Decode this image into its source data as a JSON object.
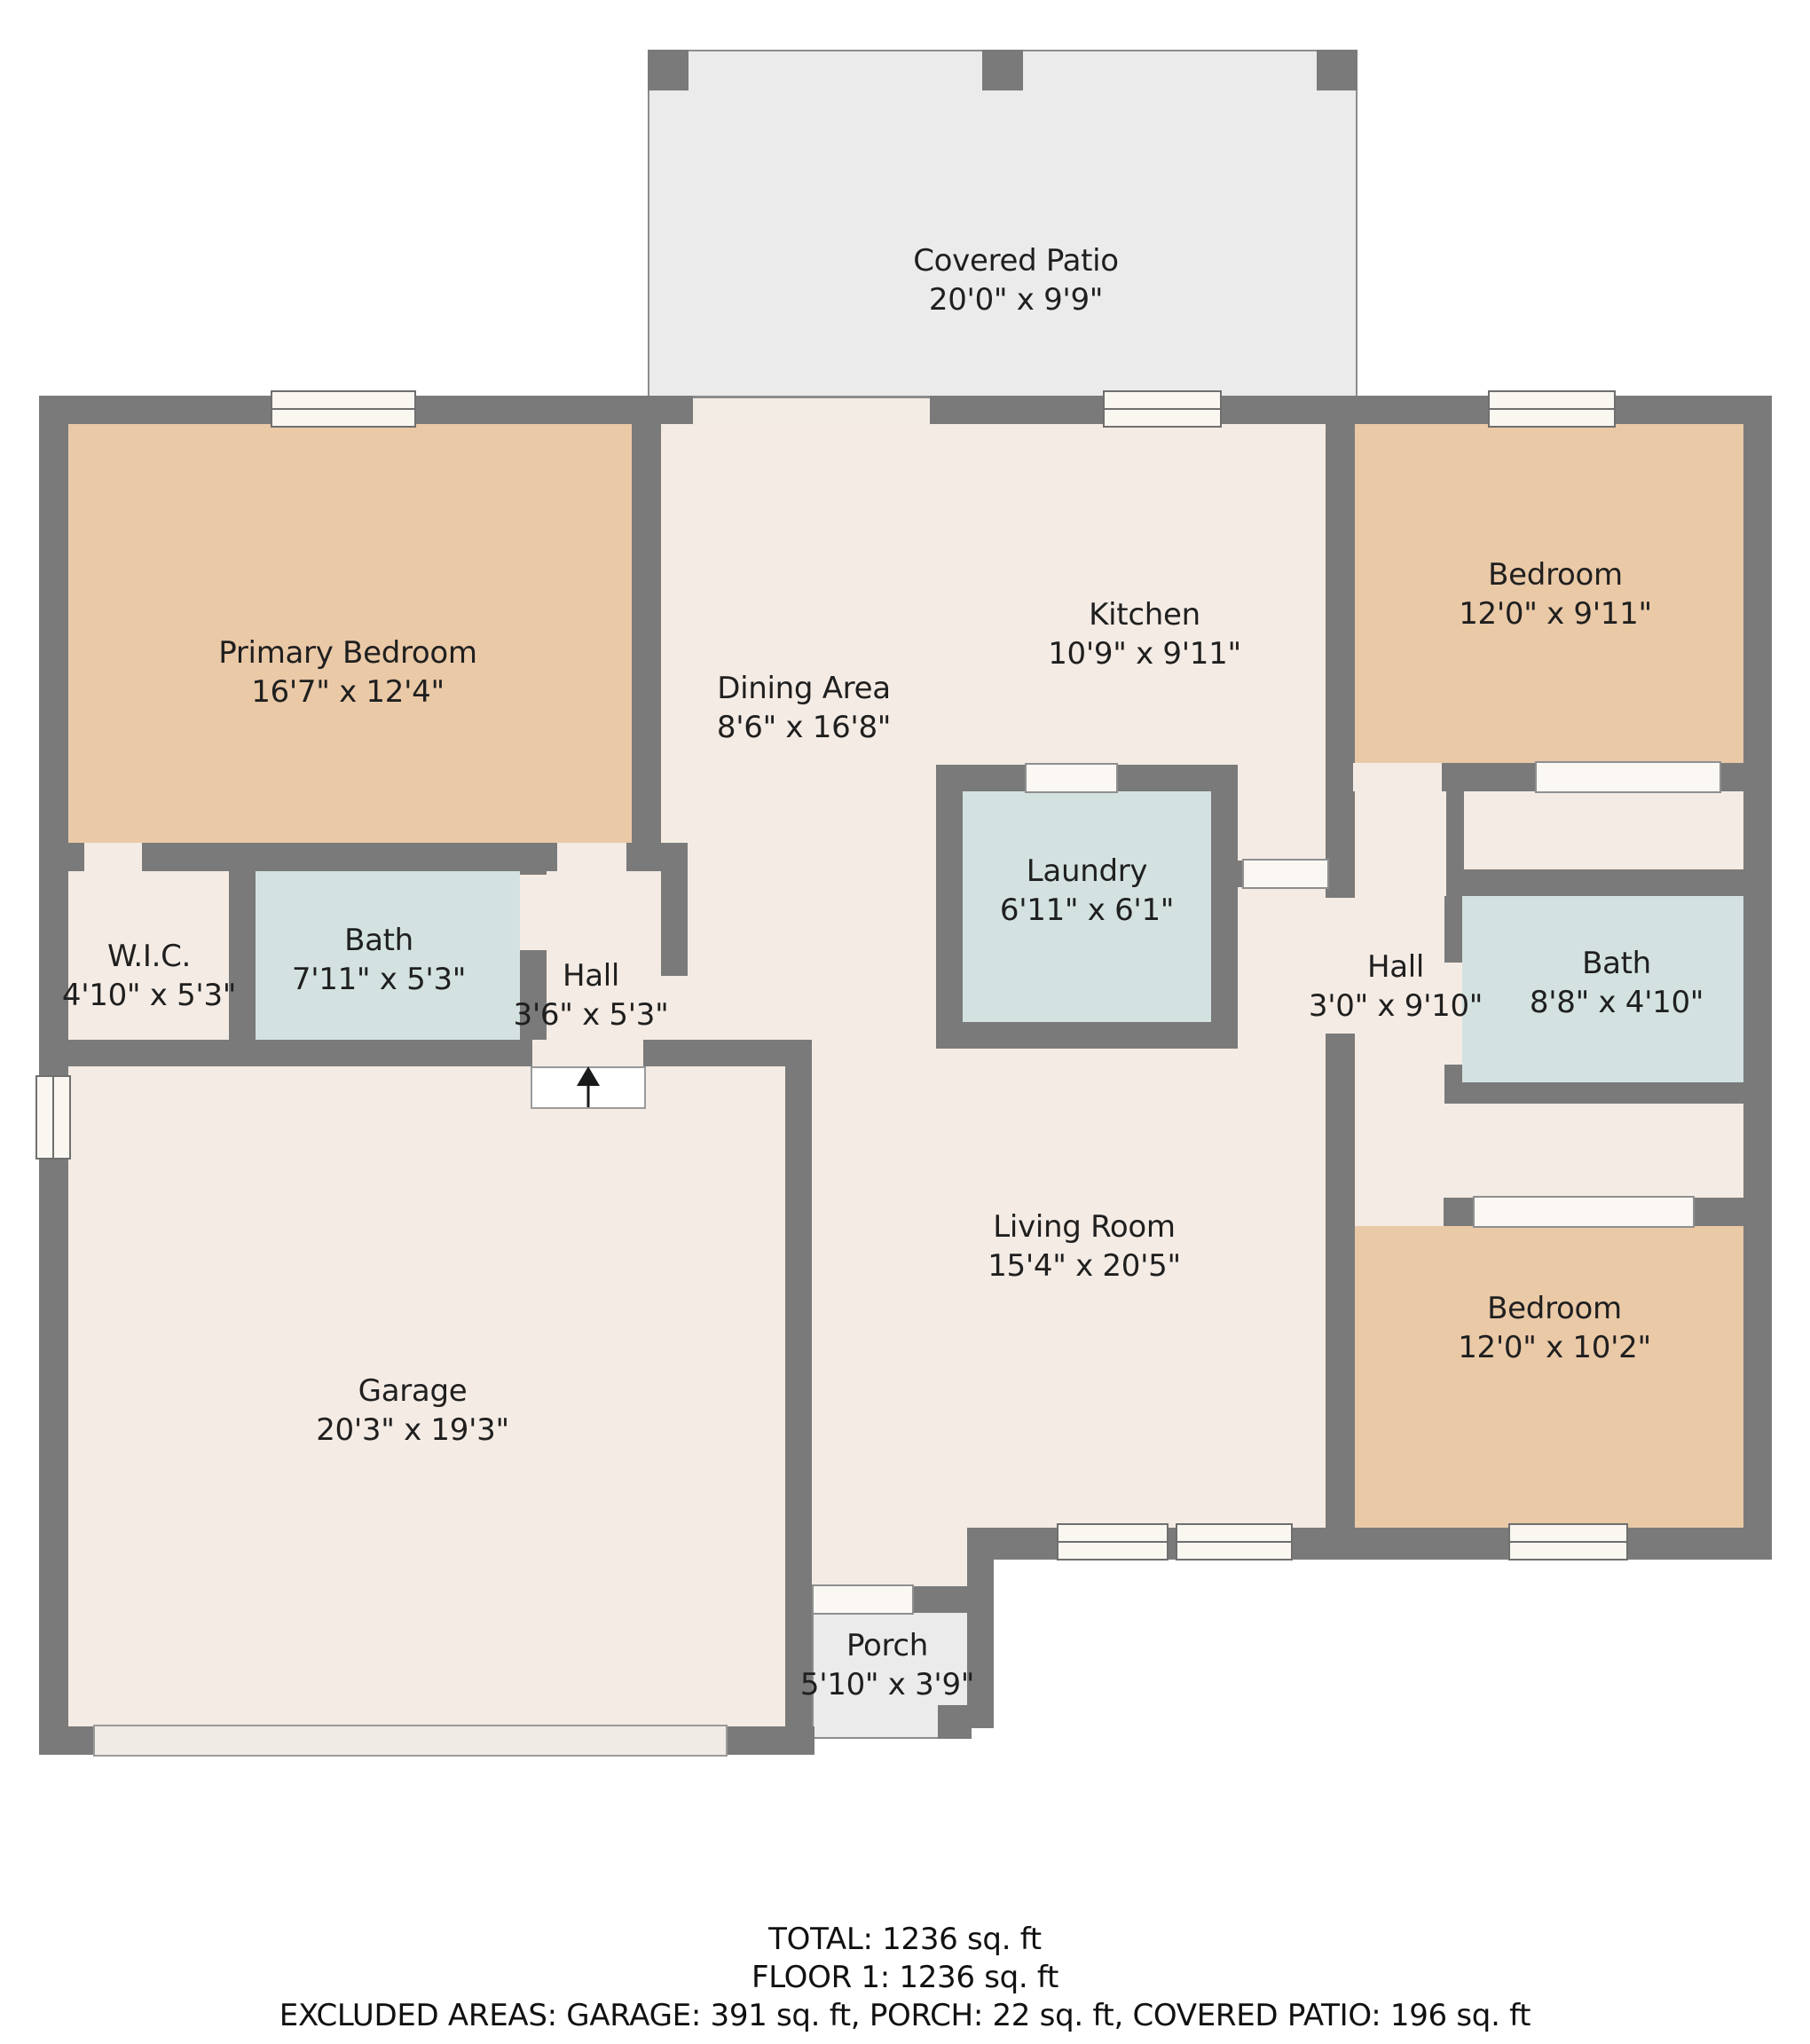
{
  "floorplan": {
    "rooms": {
      "covered_patio": {
        "name": "Covered Patio",
        "dims": "20'0\" x 9'9\""
      },
      "primary_bedroom": {
        "name": "Primary Bedroom",
        "dims": "16'7\" x 12'4\""
      },
      "dining_area": {
        "name": "Dining Area",
        "dims": "8'6\" x 16'8\""
      },
      "kitchen": {
        "name": "Kitchen",
        "dims": "10'9\" x 9'11\""
      },
      "bedroom_top_right": {
        "name": "Bedroom",
        "dims": "12'0\" x 9'11\""
      },
      "wic": {
        "name": "W.I.C.",
        "dims": "4'10\" x 5'3\""
      },
      "bath_left": {
        "name": "Bath",
        "dims": "7'11\" x 5'3\""
      },
      "hall_left": {
        "name": "Hall",
        "dims": "3'6\" x 5'3\""
      },
      "laundry": {
        "name": "Laundry",
        "dims": "6'11\" x 6'1\""
      },
      "hall_right": {
        "name": "Hall",
        "dims": "3'0\" x 9'10\""
      },
      "bath_right": {
        "name": "Bath",
        "dims": "8'8\" x 4'10\""
      },
      "living_room": {
        "name": "Living Room",
        "dims": "15'4\" x 20'5\""
      },
      "bedroom_bottom_right": {
        "name": "Bedroom",
        "dims": "12'0\" x 10'2\""
      },
      "garage": {
        "name": "Garage",
        "dims": "20'3\" x 19'3\""
      },
      "porch": {
        "name": "Porch",
        "dims": "5'10\" x 3'9\""
      }
    },
    "summary": {
      "total": "TOTAL: 1236 sq. ft",
      "floor1": "FLOOR 1: 1236 sq. ft",
      "excluded": "EXCLUDED AREAS: GARAGE: 391 sq. ft, PORCH: 22 sq. ft, COVERED PATIO: 196 sq. ft"
    },
    "colors": {
      "wall": "#7a7a7a",
      "floor": "#f4ebe4",
      "bedroom_fill": "#eac9a7",
      "bath_fill": "#d3e2e1",
      "patio_fill": "#ebebeb",
      "text": "#1f1f1f"
    }
  }
}
